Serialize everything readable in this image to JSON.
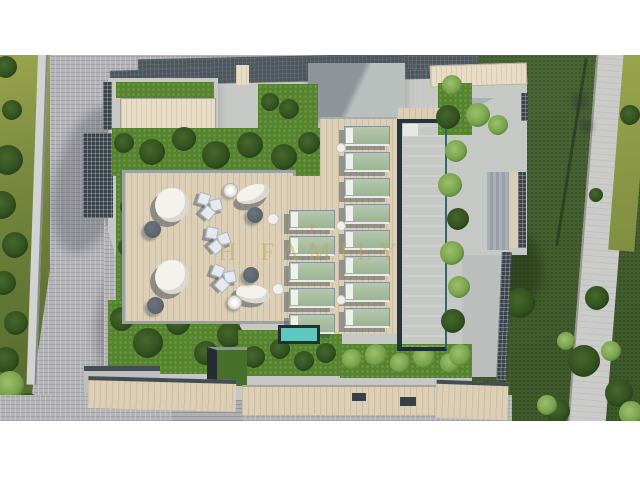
{
  "image": {
    "kind": "3d-architectural-render",
    "view": "aerial top-down",
    "subject": "Rooftop pool terrace of a residential building with surrounding gardens",
    "visible_elements": [
      "swimming pool",
      "sun loungers",
      "round daybeds",
      "lounge chair groups",
      "parasols",
      "planted roof gardens with trees",
      "timber sun deck",
      "cobbled courtyard",
      "perimeter lawn with palm trees",
      "garden path",
      "small spa"
    ]
  },
  "watermark": {
    "text": "H FAMILY",
    "ornament": "✦"
  },
  "scene_counts": {
    "sun_loungers": 13,
    "round_daybeds": 2,
    "oval_loungers": 2,
    "parasols": 2,
    "pools": 1,
    "spa": 1
  },
  "palette": {
    "pool_water": "#35c2b6",
    "pool_edge": "#233540",
    "deck_wood": "#dccfb5",
    "upper_deck_wood": "#e7ddc7",
    "concrete_roof": "#c6c8c5",
    "dark_roof": "#4d565e",
    "planting_green": "#55832f",
    "lawn_green": "#43602d",
    "side_grass": "#8c9a48",
    "paving": "#b5b5b9",
    "lounger_cushion": "#a9bea1",
    "furniture_white": "#f3f2ed",
    "watermark_gold": "#c6a054",
    "letterbox": "#ffffff"
  }
}
